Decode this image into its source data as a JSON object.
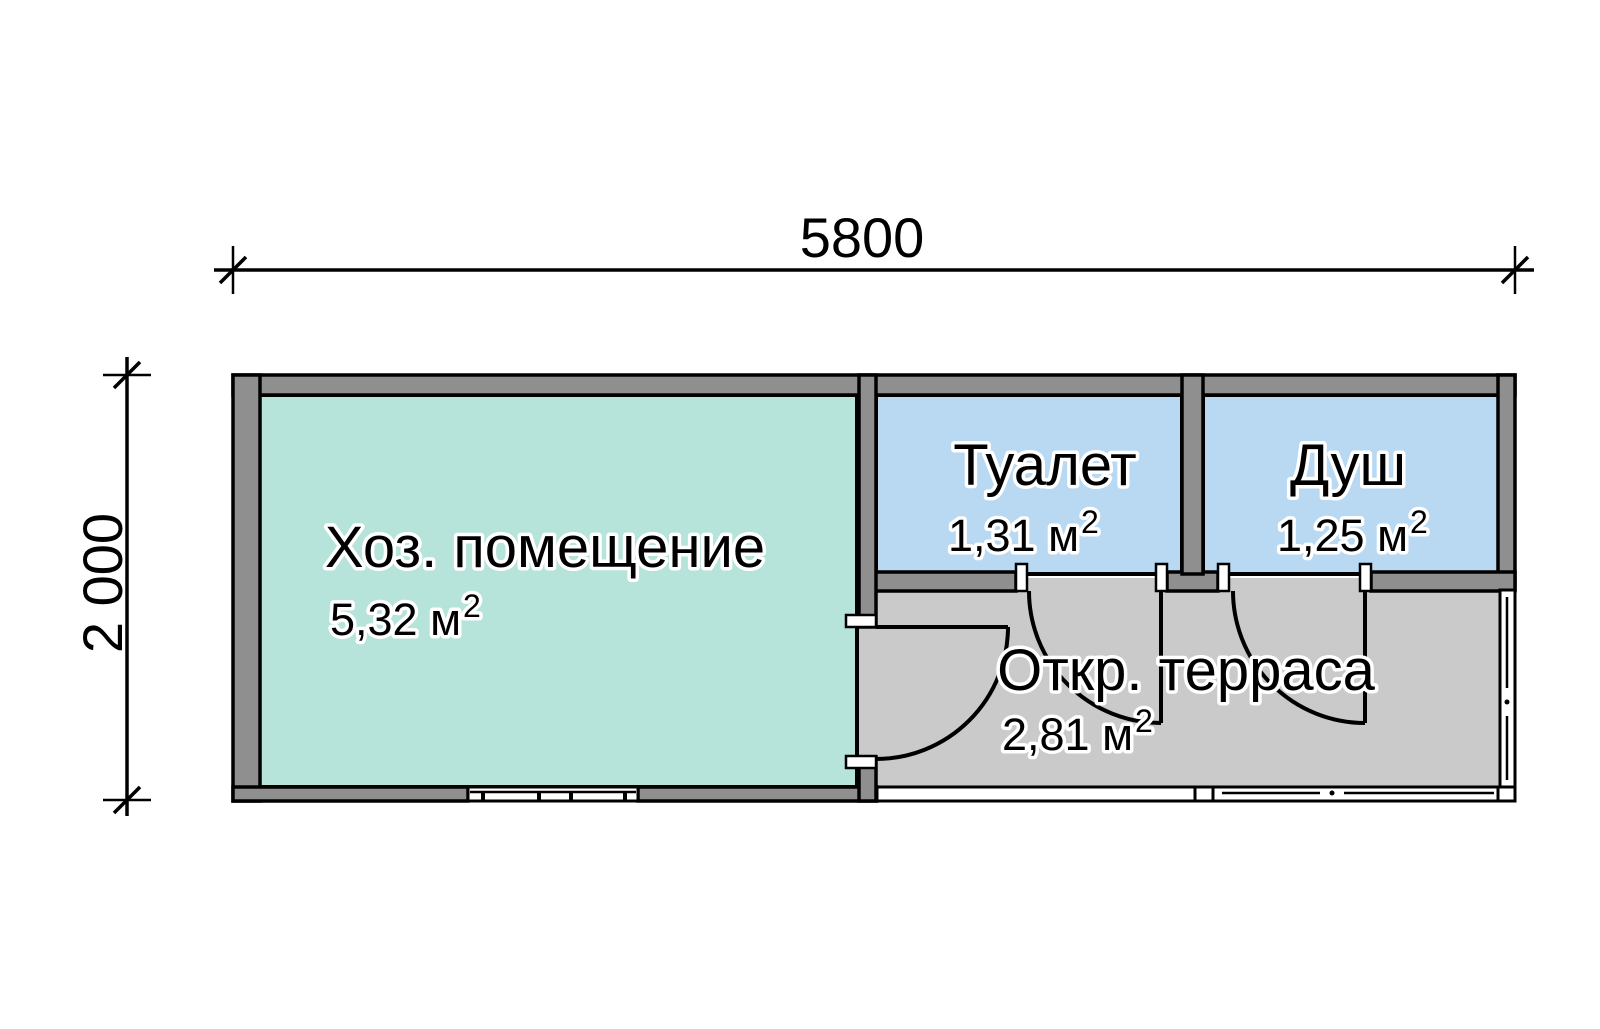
{
  "dimensions": {
    "width_label": "5800",
    "height_label": "2 000"
  },
  "rooms": {
    "utility": {
      "name": "Хоз. помещение",
      "area": "5,32 м",
      "sup": "2"
    },
    "toilet": {
      "name": "Туалет",
      "area": "1,31 м",
      "sup": "2"
    },
    "shower": {
      "name": "Душ",
      "area": "1,25 м",
      "sup": "2"
    },
    "terrace": {
      "name": "Откр. терраса",
      "area": "2,81 м",
      "sup": "2"
    }
  },
  "colors": {
    "background": "#ffffff",
    "wall": "#8f8f8f",
    "utility_fill": "#b6e3da",
    "wet_room_fill": "#b9d8f2",
    "terrace_fill": "#cacaca",
    "line": "#000000"
  }
}
